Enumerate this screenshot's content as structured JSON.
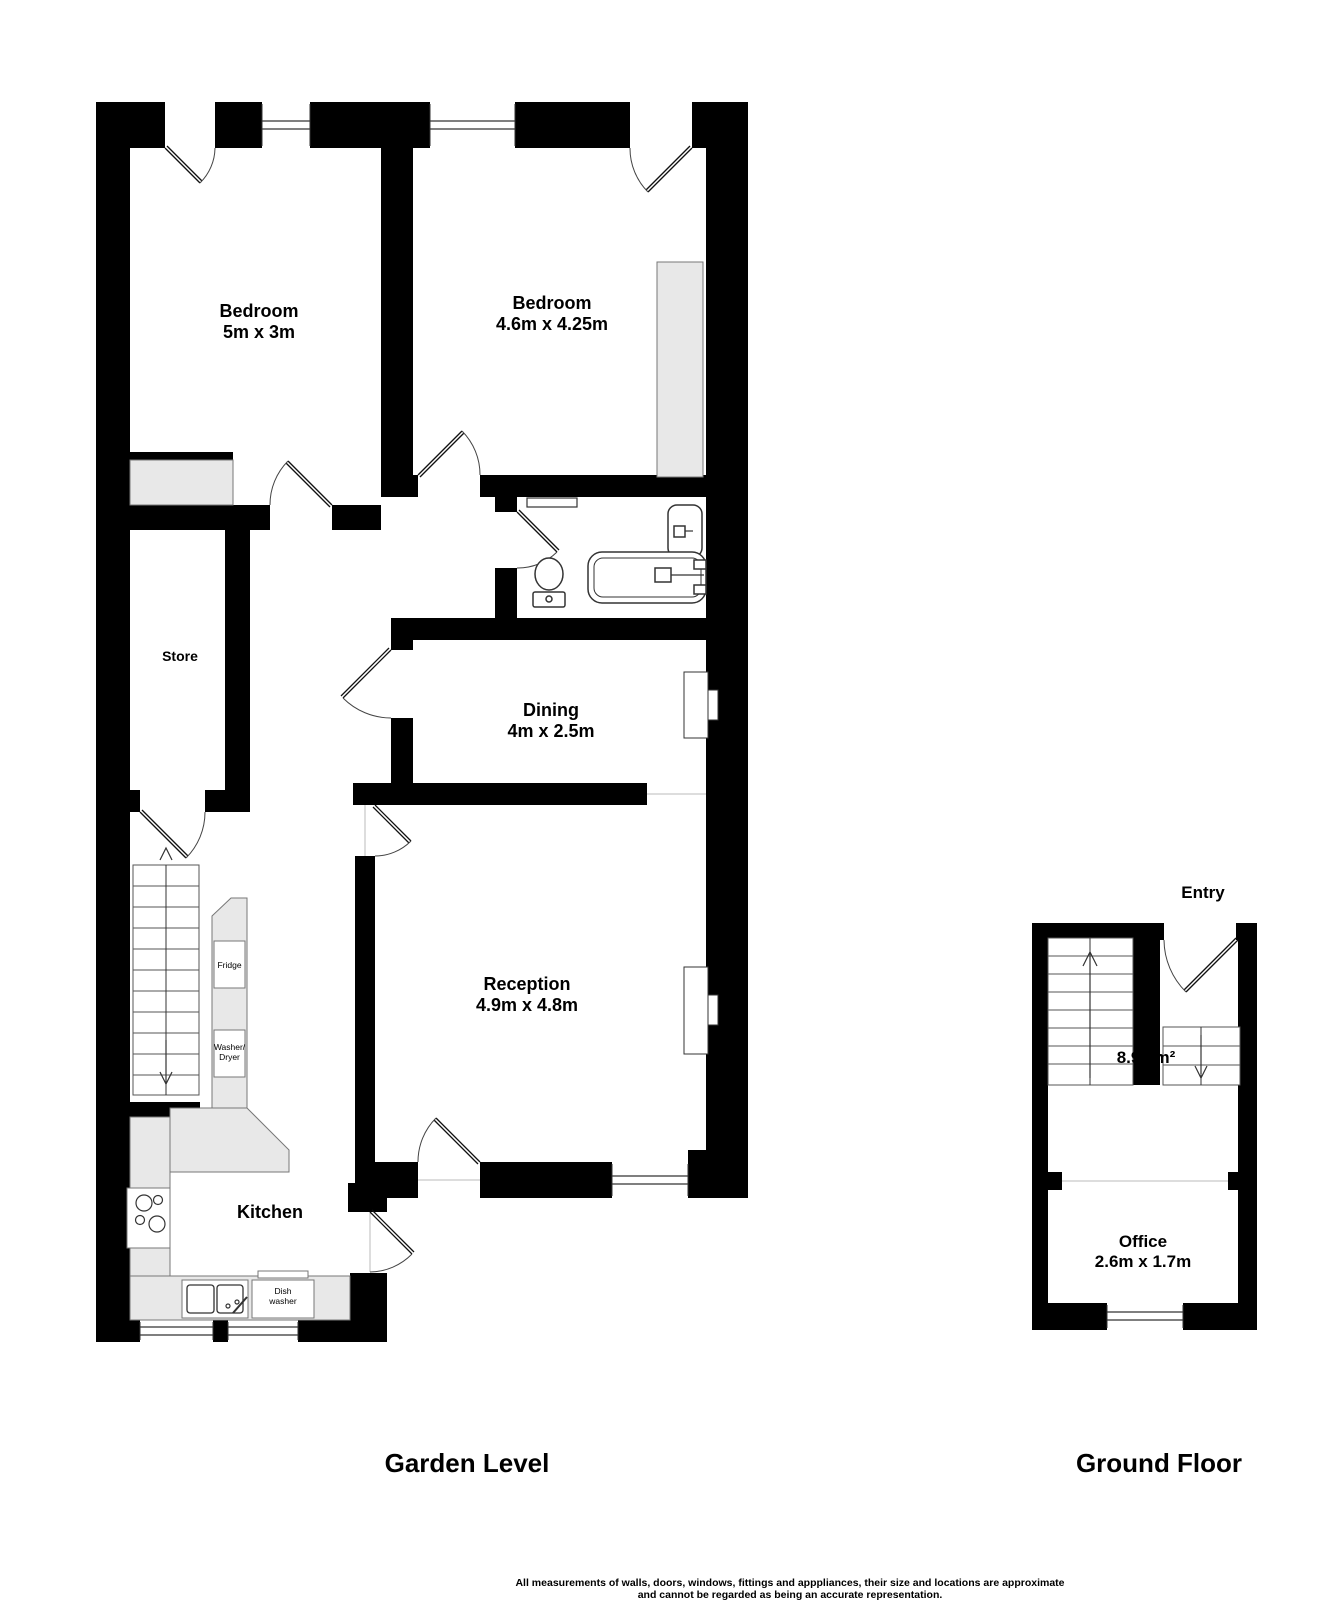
{
  "floorplan": {
    "garden_level": {
      "title": "Garden Level",
      "rooms": {
        "bedroom1": {
          "name": "Bedroom",
          "dims": "5m x 3m"
        },
        "bedroom2": {
          "name": "Bedroom",
          "dims": "4.6m x 4.25m"
        },
        "store": {
          "name": "Store"
        },
        "dining": {
          "name": "Dining",
          "dims": "4m x 2.5m"
        },
        "reception": {
          "name": "Reception",
          "dims": "4.9m x 4.8m"
        },
        "kitchen": {
          "name": "Kitchen"
        }
      },
      "appliances": {
        "fridge": "Fridge",
        "washer_dryer_line1": "Washer/",
        "washer_dryer_line2": "Dryer",
        "dishwasher_line1": "Dish",
        "dishwasher_line2": "washer"
      }
    },
    "ground_floor": {
      "title": "Ground Floor",
      "entry_label": "Entry",
      "stair_area": "8.91 m²",
      "rooms": {
        "office": {
          "name": "Office",
          "dims": "2.6m x 1.7m"
        }
      }
    },
    "disclaimer_line1": "All measurements of walls, doors, windows, fittings and apppliances, their size and locations are approximate",
    "disclaimer_line2": "and cannot be regarded as being an accurate representation.",
    "colors": {
      "wall": "#000000",
      "floor": "#ffffff",
      "fixture_gray": "#e8e8e8"
    }
  }
}
